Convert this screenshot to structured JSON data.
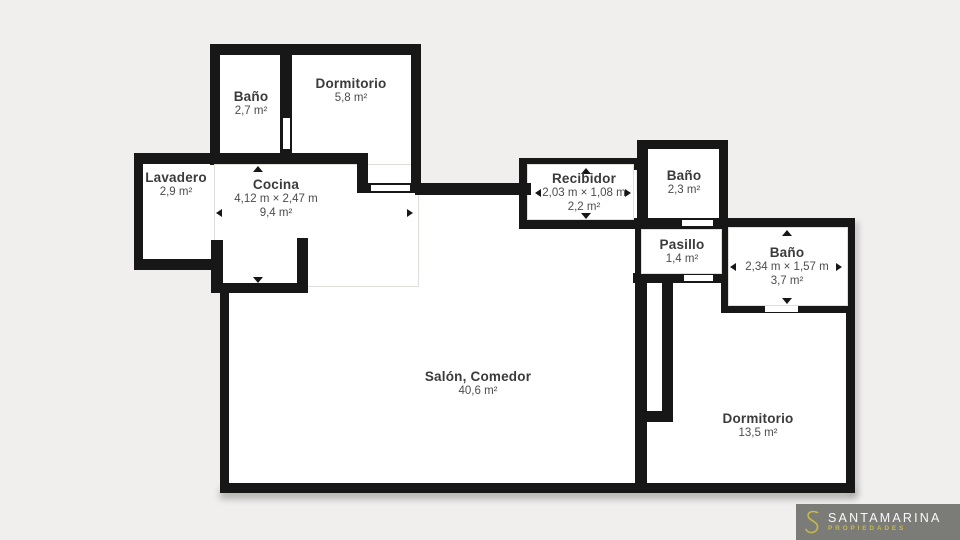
{
  "canvas": {
    "background_color": "#f0efee",
    "wall_color": "#171717",
    "room_fill_color": "#ffffff"
  },
  "rooms": [
    {
      "id": "bano-1",
      "name": "Baño",
      "area": "2,7 m²"
    },
    {
      "id": "dormitorio-1",
      "name": "Dormitorio",
      "area": "5,8 m²"
    },
    {
      "id": "lavadero",
      "name": "Lavadero",
      "area": "2,9 m²"
    },
    {
      "id": "cocina",
      "name": "Cocina",
      "dimensions": "4,12 m × 2,47 m",
      "area": "9,4 m²"
    },
    {
      "id": "recibidor",
      "name": "Recibidor",
      "dimensions": "2,03 m × 1,08 m",
      "area": "2,2 m²"
    },
    {
      "id": "bano-2",
      "name": "Baño",
      "area": "2,3 m²"
    },
    {
      "id": "pasillo",
      "name": "Pasillo",
      "area": "1,4 m²"
    },
    {
      "id": "bano-3",
      "name": "Baño",
      "dimensions": "2,34 m × 1,57 m",
      "area": "3,7 m²"
    },
    {
      "id": "salon-comedor",
      "name": "Salón, Comedor",
      "area": "40,6 m²"
    },
    {
      "id": "dormitorio-2",
      "name": "Dormitorio",
      "area": "13,5 m²"
    }
  ],
  "logo": {
    "brand": "SANTAMARINA",
    "tagline": "PROPIEDADES",
    "brand_color": "#fafafa",
    "accent_color": "#c6ba4a",
    "background_color": "#7b7b78"
  }
}
